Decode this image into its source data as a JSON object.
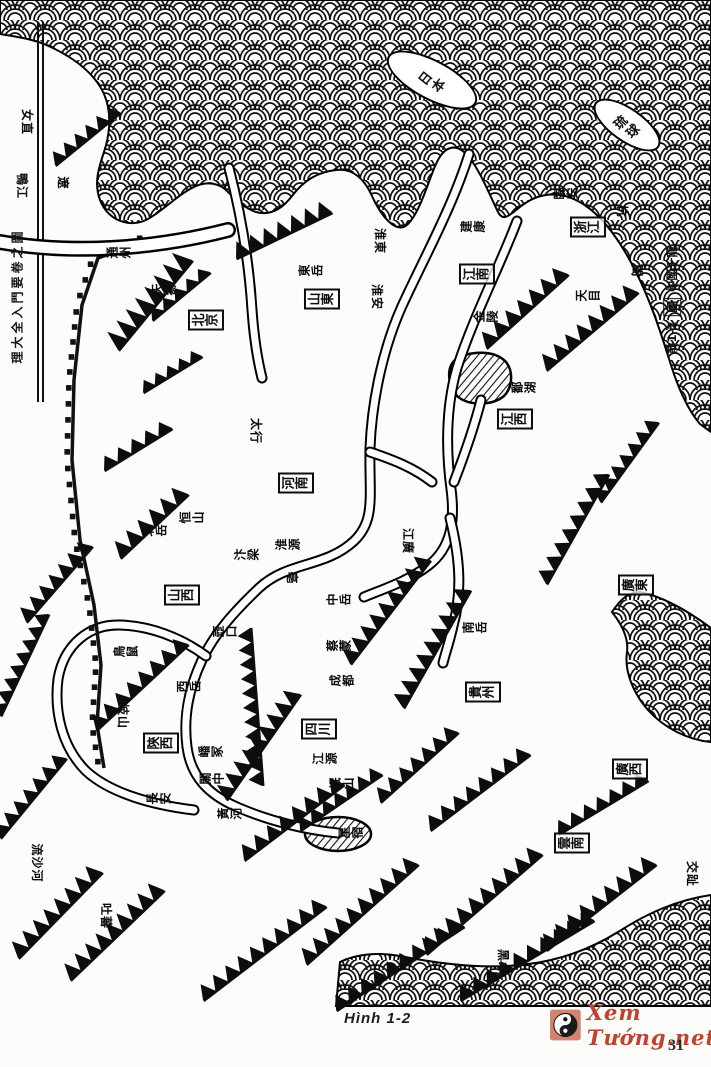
{
  "figure": {
    "caption": "Hình 1-2",
    "page_number": "31",
    "watermark_text": "Xem Tướng.net",
    "watermark_symbol": "yin-yang",
    "watermark_color": "#bf4430"
  },
  "map": {
    "description": "Old Chinese woodcut dragon-vein map of China, rotated 90 degrees, sea drawn as fish-scale waves",
    "edge_titles": {
      "left_spine": "理大全入門要卷之圖",
      "right_margin_prefix": "前1-2",
      "right_margin_boxed": "圖",
      "right_margin_suffix": "中國千龍"
    },
    "islands": [
      {
        "label": "日本",
        "x": 432,
        "y": 80,
        "w": 100,
        "h": 40,
        "rot": 28
      },
      {
        "label": "琉球",
        "x": 627,
        "y": 125,
        "w": 78,
        "h": 34,
        "rot": 35
      }
    ],
    "province_boxes": [
      {
        "label": "北京",
        "x": 206,
        "y": 320
      },
      {
        "label": "山東",
        "x": 322,
        "y": 299
      },
      {
        "label": "江南",
        "x": 477,
        "y": 274
      },
      {
        "label": "浙江",
        "x": 588,
        "y": 227
      },
      {
        "label": "江西",
        "x": 515,
        "y": 419
      },
      {
        "label": "河南",
        "x": 296,
        "y": 483
      },
      {
        "label": "山西",
        "x": 182,
        "y": 595
      },
      {
        "label": "陝西",
        "x": 161,
        "y": 743
      },
      {
        "label": "四川",
        "x": 319,
        "y": 729
      },
      {
        "label": "貴州",
        "x": 483,
        "y": 692
      },
      {
        "label": "廣東",
        "x": 636,
        "y": 585
      },
      {
        "label": "廣西",
        "x": 630,
        "y": 769
      },
      {
        "label": "雲南",
        "x": 572,
        "y": 843
      }
    ],
    "place_labels": [
      {
        "label": "女直",
        "x": 27,
        "y": 122,
        "dir": "v"
      },
      {
        "label": "鴨江",
        "x": 22,
        "y": 186,
        "dir": "v"
      },
      {
        "label": "遼",
        "x": 63,
        "y": 183,
        "dir": "v"
      },
      {
        "label": "通州",
        "x": 119,
        "y": 252,
        "dir": "h"
      },
      {
        "label": "天壽",
        "x": 164,
        "y": 289,
        "dir": "h"
      },
      {
        "label": "東岳",
        "x": 311,
        "y": 270,
        "dir": "h"
      },
      {
        "label": "淮東",
        "x": 380,
        "y": 241,
        "dir": "v"
      },
      {
        "label": "淮安",
        "x": 377,
        "y": 297,
        "dir": "v"
      },
      {
        "label": "建康",
        "x": 473,
        "y": 226,
        "dir": "h"
      },
      {
        "label": "臨安",
        "x": 566,
        "y": 193,
        "dir": "h"
      },
      {
        "label": "杭",
        "x": 622,
        "y": 211,
        "dir": "v"
      },
      {
        "label": "天目",
        "x": 588,
        "y": 295,
        "dir": "h"
      },
      {
        "label": "閩",
        "x": 637,
        "y": 271,
        "dir": "v"
      },
      {
        "label": "金陵",
        "x": 486,
        "y": 316,
        "dir": "h"
      },
      {
        "label": "鄱湖",
        "x": 524,
        "y": 387,
        "dir": "h"
      },
      {
        "label": "太行",
        "x": 256,
        "y": 431,
        "dir": "v"
      },
      {
        "label": "北岳",
        "x": 155,
        "y": 530,
        "dir": "h"
      },
      {
        "label": "恒山",
        "x": 192,
        "y": 517,
        "dir": "h"
      },
      {
        "label": "汴梁",
        "x": 247,
        "y": 554,
        "dir": "h"
      },
      {
        "label": "淮源",
        "x": 288,
        "y": 544,
        "dir": "h"
      },
      {
        "label": "亳",
        "x": 292,
        "y": 578,
        "dir": "v"
      },
      {
        "label": "中岳",
        "x": 339,
        "y": 599,
        "dir": "h"
      },
      {
        "label": "江廣",
        "x": 408,
        "y": 541,
        "dir": "v"
      },
      {
        "label": "壺口",
        "x": 225,
        "y": 631,
        "dir": "h"
      },
      {
        "label": "鳥鼠",
        "x": 126,
        "y": 651,
        "dir": "h"
      },
      {
        "label": "西岳",
        "x": 189,
        "y": 686,
        "dir": "h"
      },
      {
        "label": "岐山",
        "x": 123,
        "y": 716,
        "dir": "v"
      },
      {
        "label": "嶓冢",
        "x": 211,
        "y": 751,
        "dir": "h"
      },
      {
        "label": "關中",
        "x": 212,
        "y": 778,
        "dir": "h"
      },
      {
        "label": "長安",
        "x": 159,
        "y": 798,
        "dir": "h"
      },
      {
        "label": "黃河",
        "x": 230,
        "y": 813,
        "dir": "h"
      },
      {
        "label": "蔡蒙",
        "x": 339,
        "y": 645,
        "dir": "h"
      },
      {
        "label": "成都",
        "x": 342,
        "y": 680,
        "dir": "h"
      },
      {
        "label": "江源",
        "x": 325,
        "y": 758,
        "dir": "h"
      },
      {
        "label": "岷山",
        "x": 342,
        "y": 783,
        "dir": "h"
      },
      {
        "label": "南岳",
        "x": 475,
        "y": 627,
        "dir": "h"
      },
      {
        "label": "星宿",
        "x": 351,
        "y": 832,
        "dir": "h"
      },
      {
        "label": "吐蕃",
        "x": 106,
        "y": 916,
        "dir": "v"
      },
      {
        "label": "流沙河",
        "x": 37,
        "y": 863,
        "dir": "v"
      },
      {
        "label": "黑水",
        "x": 503,
        "y": 962,
        "dir": "v"
      },
      {
        "label": "交趾",
        "x": 692,
        "y": 874,
        "dir": "v"
      }
    ]
  }
}
